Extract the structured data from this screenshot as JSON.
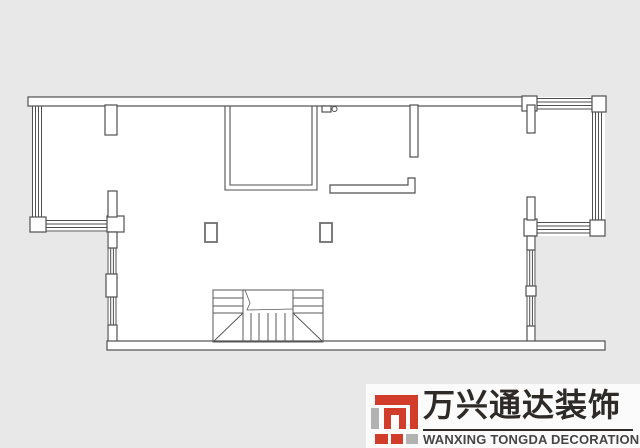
{
  "page": {
    "background_color": "#e8e8e8",
    "type": "floor-plan-drawing"
  },
  "plan": {
    "line_color": "#4f4f4f",
    "interior_fill": "#ffffff",
    "features": [
      "top-wall",
      "left-bay-window",
      "right-bay-window",
      "top-middle-room",
      "door-symbol",
      "counter",
      "two-columns",
      "staircase",
      "bottom-wall"
    ]
  },
  "logo": {
    "company_cn": "万兴通达装饰",
    "company_en": "WANXING TONGDA DECORATION",
    "brand_red": "#d23c2a",
    "brand_gray": "#b2b2b2",
    "cn_text_color": "#2d2a27",
    "en_text_color": "#454545",
    "panel_background": "#fbfbfb"
  }
}
